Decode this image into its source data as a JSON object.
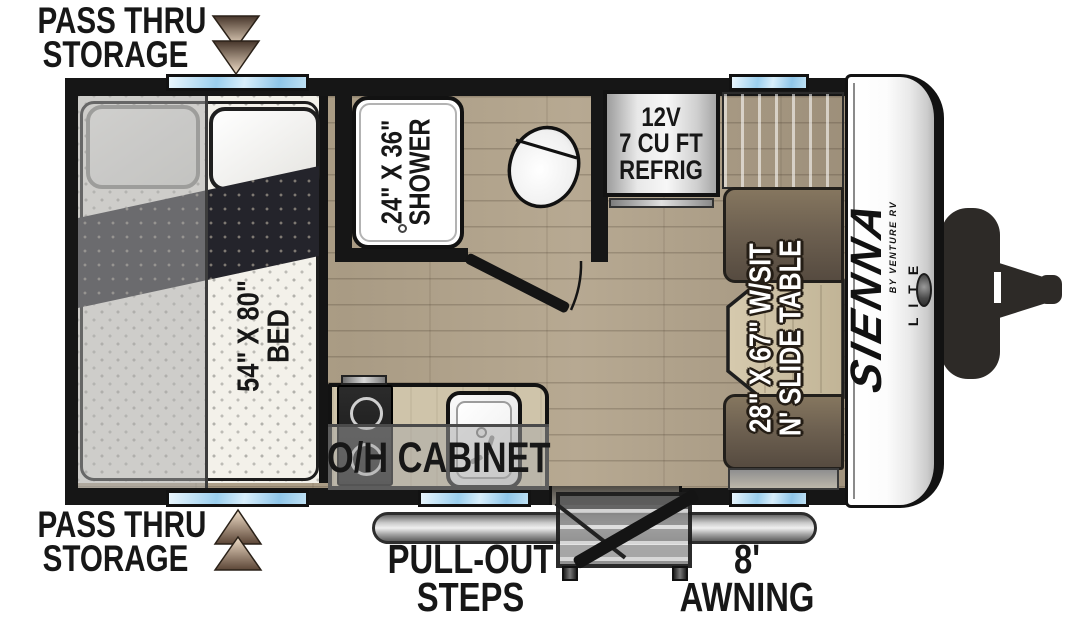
{
  "labels": {
    "pass_thru_top": [
      "PASS THRU",
      "STORAGE"
    ],
    "pass_thru_bottom": [
      "PASS THRU",
      "STORAGE"
    ],
    "bed_overhead_cabinet": "O/H CABINET",
    "bed": [
      "54\" X 80\"",
      "BED"
    ],
    "shower": [
      "24\" X 36\"",
      "SHOWER"
    ],
    "refrigerator": [
      "12V",
      "7 CU FT",
      "REFRIG"
    ],
    "dinette": [
      "28\" X 67\" W/SIT",
      "N' SLIDE TABLE"
    ],
    "kitchen_overhead_cabinet": "O/H CABINET",
    "pull_out_steps": [
      "PULL-OUT",
      "STEPS"
    ],
    "awning": [
      "8'",
      "AWNING"
    ]
  },
  "brand": {
    "name": "SIENNA",
    "byline": "BY VENTURE RV",
    "trim": "LITE"
  },
  "colors": {
    "wall": "#161616",
    "floor_wood": "#b2a48c",
    "window_blue": "#9bcfee",
    "seat_brown": "#6e6151",
    "table_wood": "#cdbfa3",
    "overlay_gray": "rgba(170,170,170,0.5)",
    "arrow_dark": "#46352a",
    "arrow_light": "#f1dfc9",
    "awning_gray": "#c9c9c9"
  }
}
